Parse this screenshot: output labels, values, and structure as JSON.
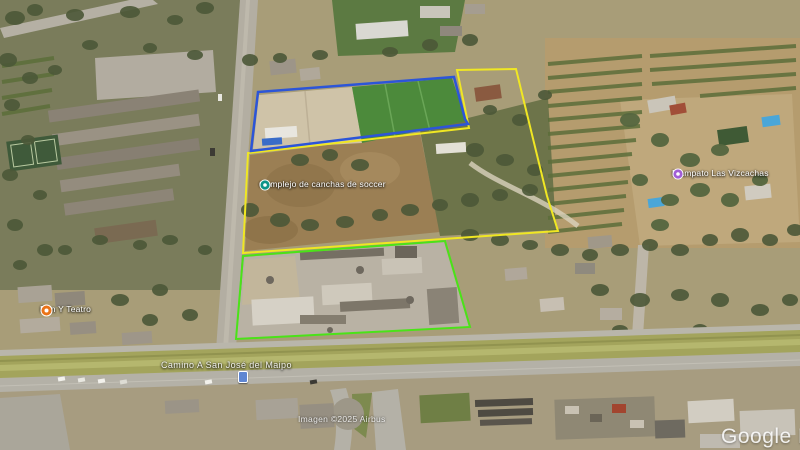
{
  "map": {
    "attribution": "Imagen ©2025 Airbus",
    "watermark": "Google Earth"
  },
  "pois": [
    {
      "label": "Complejo de canchas de soccer",
      "color": "#0d9488",
      "icon": "sports-icon"
    },
    {
      "label": "Mampato Las Vizcachas",
      "color": "#a15ed6",
      "icon": "park-icon"
    },
    {
      "label": "Pan Y Teatro",
      "color": "#ea7317",
      "icon": "restaurant-icon"
    }
  ],
  "road": {
    "name": "Camino A San José del Maipo"
  },
  "overlays": {
    "blue_parcel_color": "#2c55d8",
    "yellow_parcel_color": "#f0e723",
    "green_parcel_color": "#4ae318"
  }
}
